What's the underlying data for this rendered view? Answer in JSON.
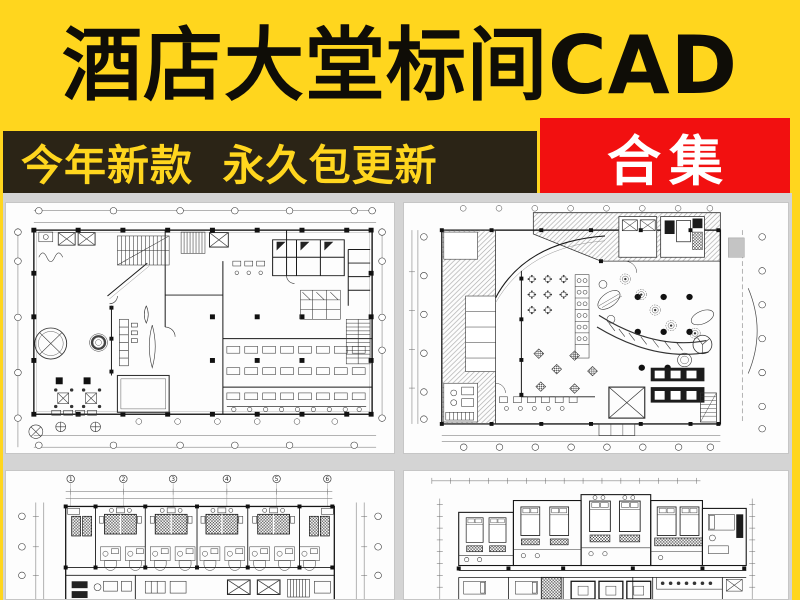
{
  "title_banner": {
    "title": "酒店大堂标间CAD"
  },
  "promo_banner": {
    "left_text": "今年新款 永久包更新",
    "badge_text": "合集"
  },
  "colors": {
    "yellow": "#ffd61e",
    "dark_bar": "#2b2416",
    "red": "#f21010",
    "title_black": "#0f0d07",
    "panel_bg": "#fdfdfd",
    "area_gray": "#d4d4d4",
    "cad_line": "#333333"
  },
  "plans": {
    "top_left": {
      "label": "hotel-lobby-floorplan-1"
    },
    "top_right": {
      "label": "hotel-lobby-floorplan-2"
    },
    "bottom_left": {
      "label": "standard-rooms-floorplan-1",
      "grid_labels": [
        "1",
        "2",
        "3",
        "4",
        "5",
        "6"
      ]
    },
    "bottom_right": {
      "label": "standard-rooms-floorplan-2"
    }
  }
}
